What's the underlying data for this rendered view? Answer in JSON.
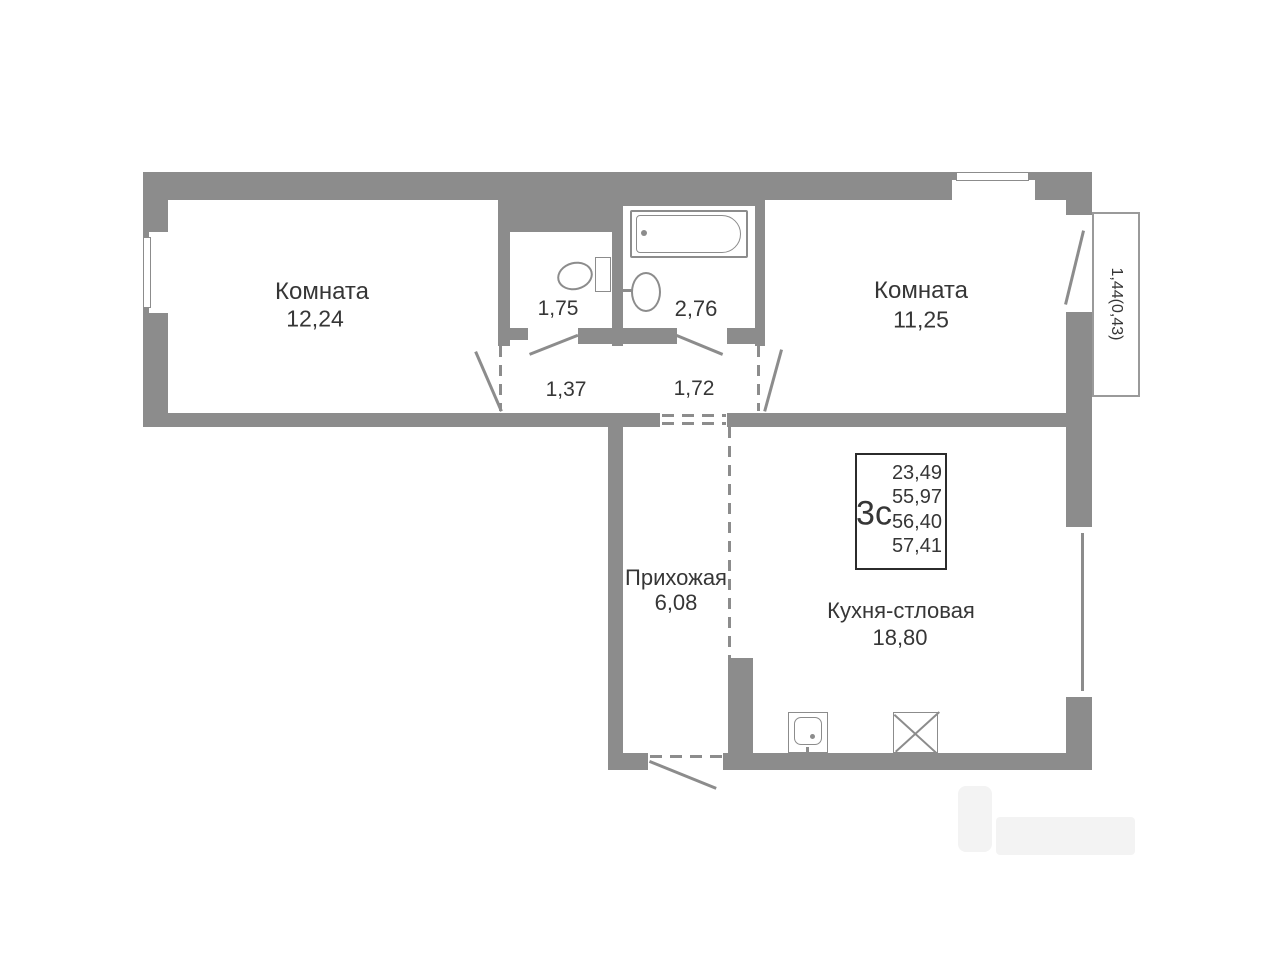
{
  "plan_title": "apartment-floor-plan",
  "rooms": {
    "room_left": {
      "name": "Комната",
      "area": "12,24"
    },
    "room_right": {
      "name": "Комната",
      "area": "11,25"
    },
    "wc": {
      "area": "1,75"
    },
    "bathroom": {
      "area": "2,76"
    },
    "corridor_left": {
      "area": "1,37"
    },
    "corridor_right": {
      "area": "1,72"
    },
    "hallway": {
      "name": "Прихожая",
      "area": "6,08"
    },
    "kitchen": {
      "name": "Кухня-стловая",
      "area": "18,80"
    },
    "balcony": {
      "area": "1,44(0,43)"
    }
  },
  "stats": {
    "type_label": "3с",
    "areas": [
      "23,49",
      "55,97",
      "56,40",
      "57,41"
    ]
  },
  "colors": {
    "wall": "#8c8c8c",
    "text": "#363636",
    "stats_border": "#2b2b2b",
    "watermark": "#f3f3f3"
  },
  "icons": {
    "bathtub": "css-shape",
    "toilet": "css-shape",
    "bath_sink": "css-shape",
    "kitchen_sink": "css-shape",
    "stove": "css-shape-x",
    "windows": "css-shape",
    "door_swings": "css-lines"
  }
}
